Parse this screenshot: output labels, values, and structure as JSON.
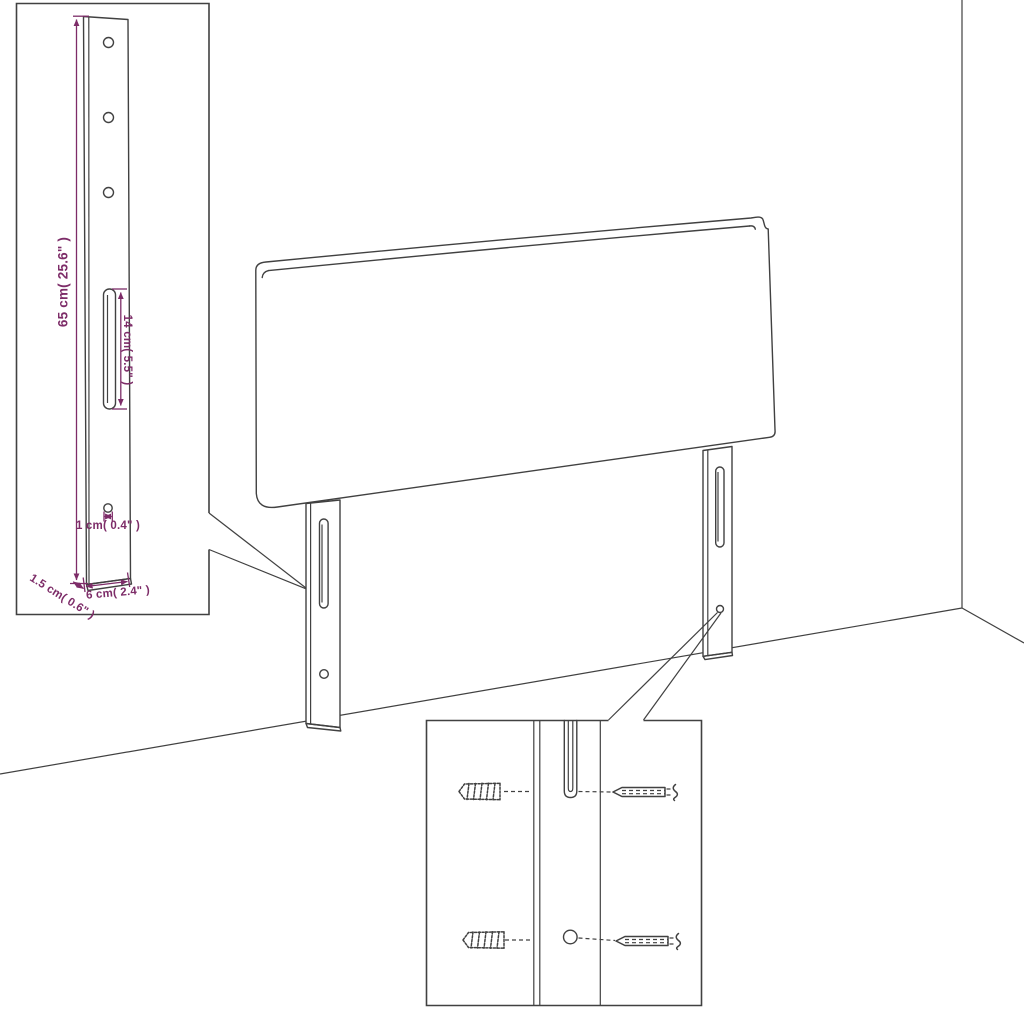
{
  "illustration_title": "headboard-with-legs-assembly-diagram",
  "dimension_labels": {
    "height": "65 cm( 25.6\" )",
    "slot": "14 cm( 5.5\" )",
    "hole": "1 cm( 0.4\" )",
    "thickness": "1.5 cm( 0.6\" )",
    "width": "6 cm( 2.4\" )"
  },
  "icons": {
    "wall_plug": "wall-plug-icon",
    "screw": "screw-icon"
  },
  "colors": {
    "line": "#414141",
    "dimension": "#7d2c68",
    "background": "#ffffff"
  }
}
